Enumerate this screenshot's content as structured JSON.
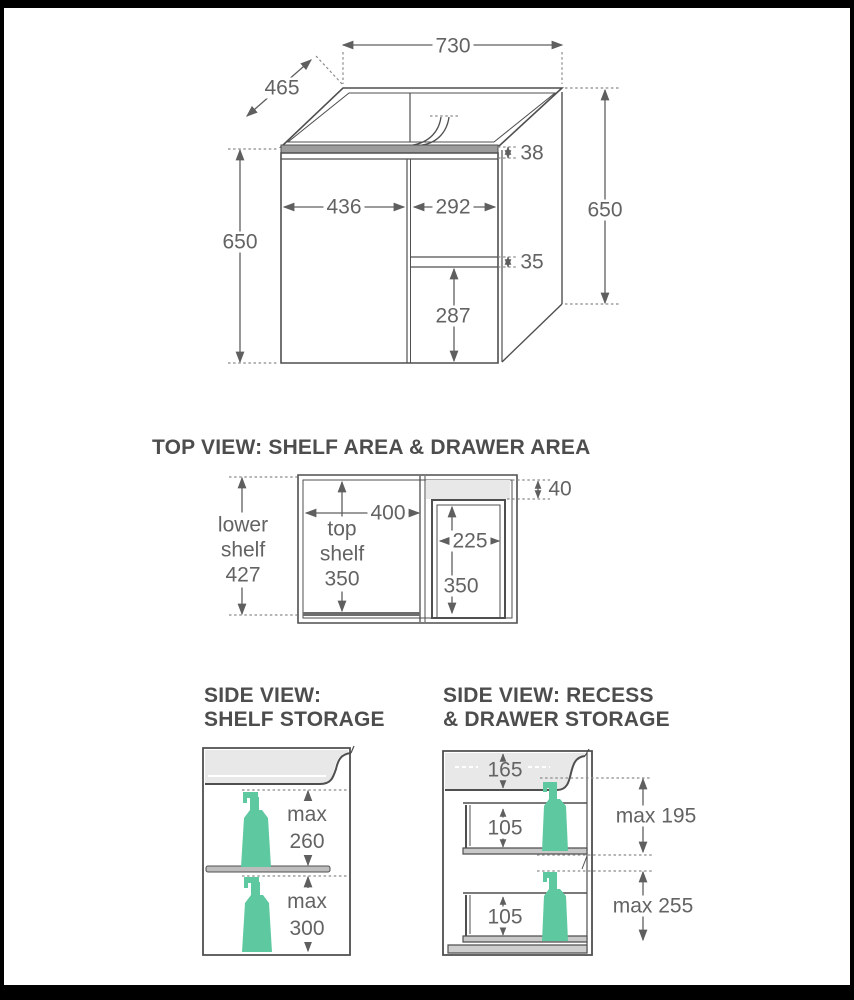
{
  "isometric": {
    "width_top": "730",
    "depth": "465",
    "height_left": "650",
    "height_right": "650",
    "door_width": "436",
    "drawer_width": "292",
    "top_rail": "38",
    "drawer_gap": "35",
    "drawer_front": "287"
  },
  "top_view": {
    "title": "TOP VIEW: SHELF AREA & DRAWER AREA",
    "lower_shelf": {
      "l1": "lower",
      "l2": "shelf",
      "l3": "427"
    },
    "top_shelf": {
      "l1": "top",
      "l2": "shelf",
      "l3": "350"
    },
    "shelf_width": "400",
    "drawer_width": "225",
    "drawer_depth": "350",
    "recess_depth": "40"
  },
  "side_left": {
    "title_l1": "SIDE VIEW:",
    "title_l2": "SHELF STORAGE",
    "upper": {
      "l1": "max",
      "l2": "260"
    },
    "lower": {
      "l1": "max",
      "l2": "300"
    }
  },
  "side_right": {
    "title_l1": "SIDE VIEW: RECESS",
    "title_l2": "& DRAWER STORAGE",
    "recess": "165",
    "upper_drawer": "105",
    "lower_drawer": "105",
    "max_upper": "max 195",
    "max_lower": "max 255"
  },
  "colors": {
    "bottle": "#5ec9a0",
    "line": "#4f4f4f",
    "shade": "#e8e8e8",
    "bench": "#9c9c9c",
    "dim_text": "#636363",
    "title_text": "#4d4d4d"
  }
}
